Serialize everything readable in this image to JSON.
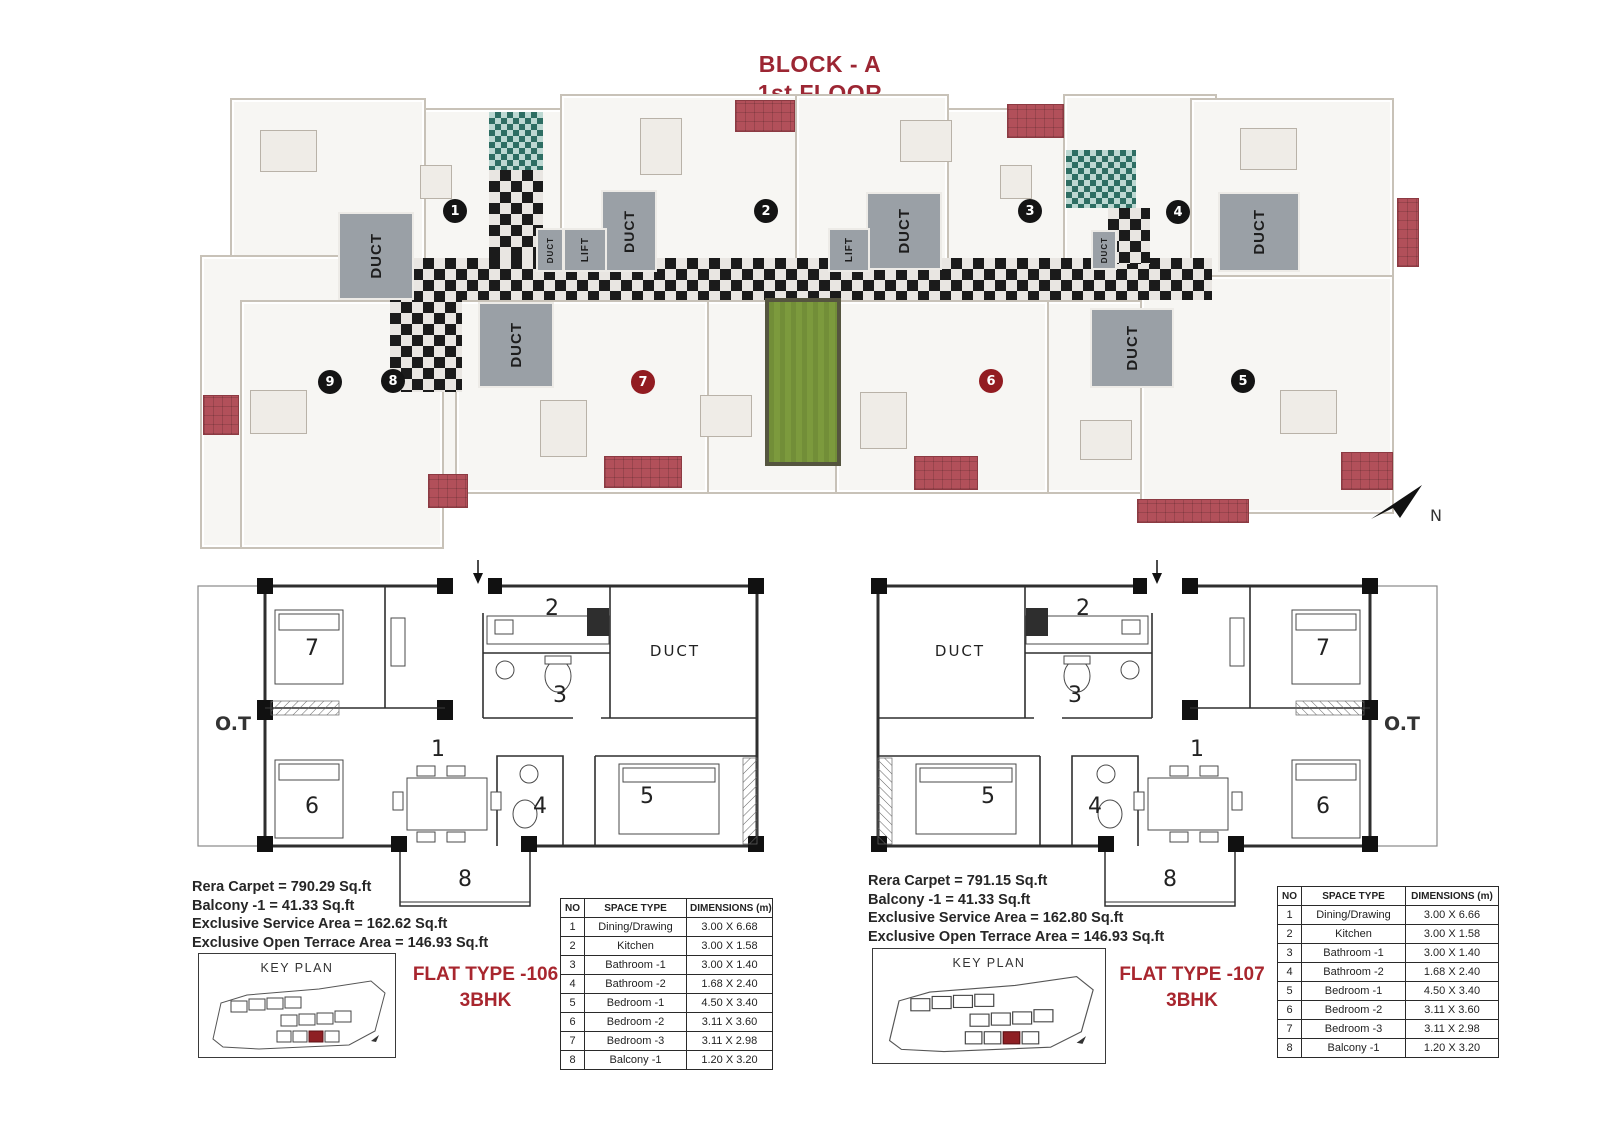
{
  "title": {
    "block": "BLOCK - A",
    "floor": "1st FLOOR"
  },
  "compass_label": "N",
  "colors": {
    "title_red": "#9C2633",
    "flat_type_red": "#A8262E",
    "badge_black": "#141414",
    "badge_red": "#921C21",
    "terrace_red": "#B2505A",
    "courtyard_green": "#7C9A3D",
    "duct_gray": "#9AA0A6",
    "corridor_dark": "#1B1B1B",
    "bath_teal": "#2E6E63"
  },
  "main_plan": {
    "duct_label": "DUCT",
    "lift_label": "LIFT",
    "unit_badges": [
      {
        "no": "1",
        "variant": "black"
      },
      {
        "no": "2",
        "variant": "black"
      },
      {
        "no": "3",
        "variant": "black"
      },
      {
        "no": "4",
        "variant": "black"
      },
      {
        "no": "5",
        "variant": "black"
      },
      {
        "no": "6",
        "variant": "red"
      },
      {
        "no": "7",
        "variant": "red"
      },
      {
        "no": "8",
        "variant": "black"
      },
      {
        "no": "9",
        "variant": "black"
      }
    ]
  },
  "flats": [
    {
      "flat_type": "FLAT TYPE -106",
      "bhk": "3BHK",
      "stats": [
        "Rera Carpet = 790.29 Sq.ft",
        "Balcony -1 = 41.33 Sq.ft",
        "Exclusive Service Area = 162.62 Sq.ft",
        "Exclusive Open Terrace Area = 146.93 Sq.ft"
      ],
      "key_plan_label": "KEY PLAN",
      "plan_labels": {
        "ot": "O.T",
        "duct": "DUCT",
        "r1": "1",
        "r2": "2",
        "r3": "3",
        "r4": "4",
        "r5": "5",
        "r6": "6",
        "r7": "7",
        "r8": "8"
      },
      "table": {
        "headers": [
          "NO",
          "SPACE TYPE",
          "DIMENSIONS (m)"
        ],
        "rows": [
          [
            "1",
            "Dining/Drawing",
            "3.00 X 6.68"
          ],
          [
            "2",
            "Kitchen",
            "3.00 X 1.58"
          ],
          [
            "3",
            "Bathroom -1",
            "3.00 X 1.40"
          ],
          [
            "4",
            "Bathroom -2",
            "1.68 X 2.40"
          ],
          [
            "5",
            "Bedroom -1",
            "4.50 X 3.40"
          ],
          [
            "6",
            "Bedroom -2",
            "3.11 X 3.60"
          ],
          [
            "7",
            "Bedroom -3",
            "3.11 X 2.98"
          ],
          [
            "8",
            "Balcony -1",
            "1.20 X 3.20"
          ]
        ]
      }
    },
    {
      "flat_type": "FLAT TYPE -107",
      "bhk": "3BHK",
      "stats": [
        "Rera Carpet = 791.15 Sq.ft",
        "Balcony -1 = 41.33 Sq.ft",
        "Exclusive Service Area = 162.80 Sq.ft",
        "Exclusive Open Terrace Area = 146.93 Sq.ft"
      ],
      "key_plan_label": "KEY PLAN",
      "plan_labels": {
        "ot": "O.T",
        "duct": "DUCT",
        "r1": "1",
        "r2": "2",
        "r3": "3",
        "r4": "4",
        "r5": "5",
        "r6": "6",
        "r7": "7",
        "r8": "8"
      },
      "table": {
        "headers": [
          "NO",
          "SPACE TYPE",
          "DIMENSIONS (m)"
        ],
        "rows": [
          [
            "1",
            "Dining/Drawing",
            "3.00 X 6.66"
          ],
          [
            "2",
            "Kitchen",
            "3.00 X 1.58"
          ],
          [
            "3",
            "Bathroom -1",
            "3.00 X 1.40"
          ],
          [
            "4",
            "Bathroom -2",
            "1.68 X 2.40"
          ],
          [
            "5",
            "Bedroom -1",
            "4.50 X 3.40"
          ],
          [
            "6",
            "Bedroom -2",
            "3.11 X 3.60"
          ],
          [
            "7",
            "Bedroom -3",
            "3.11 X 2.98"
          ],
          [
            "8",
            "Balcony -1",
            "1.20 X 3.20"
          ]
        ]
      }
    }
  ]
}
